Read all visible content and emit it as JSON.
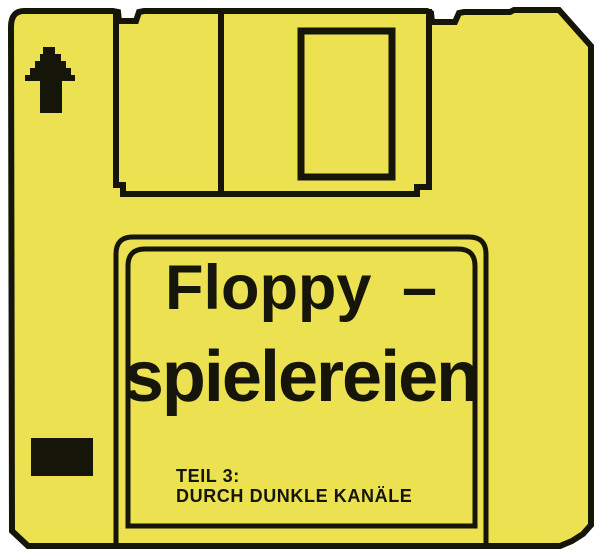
{
  "colors": {
    "background": "#ffffff",
    "disk_yellow": "#ECE151",
    "ink_black": "#161509"
  },
  "disk_label": {
    "title_line1": "Floppy –",
    "title_line2": "spielereien",
    "part_line1": "TEIL 3:",
    "part_line2": "DURCH DUNKLE KANÄLE"
  },
  "icons": {
    "arrow_up": "pixelated-up-arrow"
  }
}
